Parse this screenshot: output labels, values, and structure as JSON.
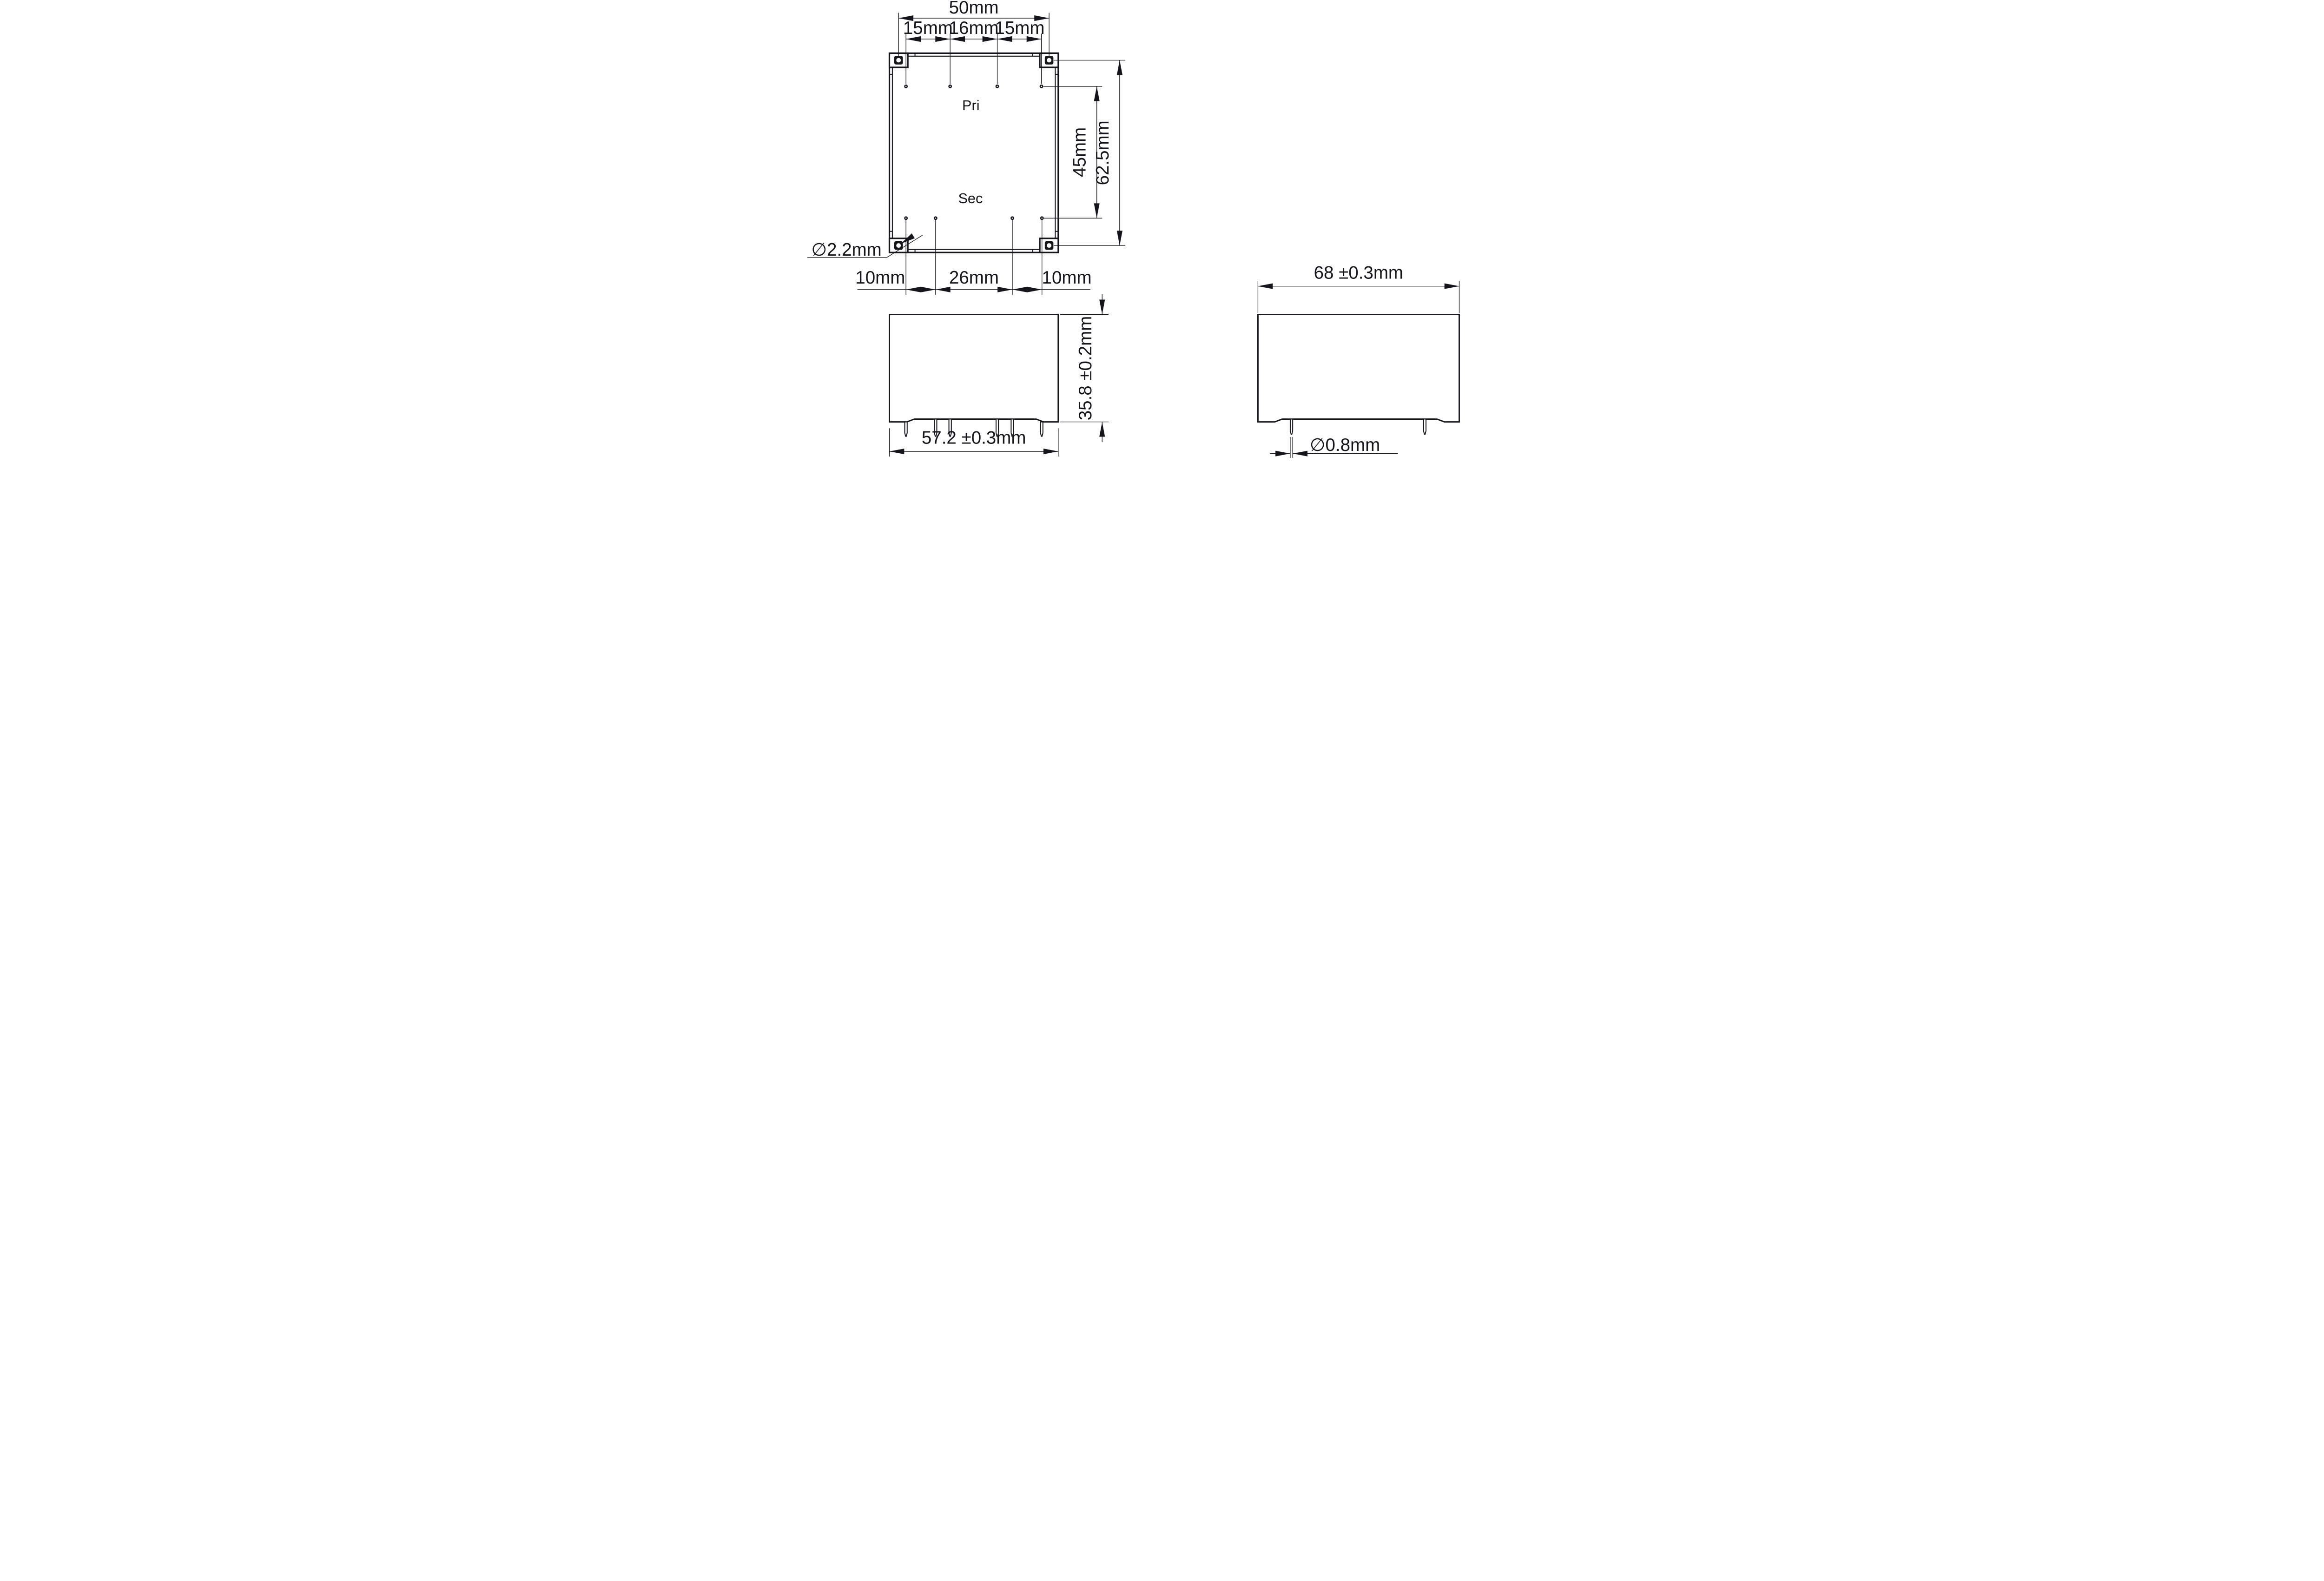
{
  "colors": {
    "background": "#ffffff",
    "ink": "#15151d"
  },
  "views": {
    "top_view": {
      "pri_label": "Pri",
      "sec_label": "Sec",
      "dim_overall_width": "50mm",
      "dim_pin_pitch": [
        "15mm",
        "16mm",
        "15mm"
      ],
      "dim_pin_row_spacing": "45mm",
      "dim_overall_height": "62.5mm",
      "dim_corner_hole_dia": "∅2.2mm",
      "dim_bottom_pitch": [
        "10mm",
        "26mm",
        "10mm"
      ]
    },
    "front_view": {
      "dim_width": "57.2 ±0.3mm",
      "dim_height": "35.8 ±0.2mm"
    },
    "side_view": {
      "dim_width": "68 ±0.3mm",
      "dim_pin_dia": "∅0.8mm"
    }
  }
}
